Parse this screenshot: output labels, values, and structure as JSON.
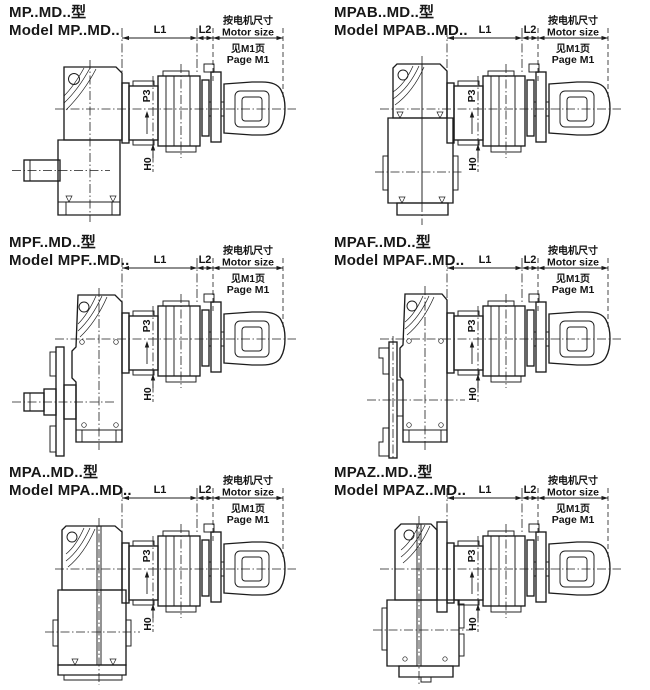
{
  "colors": {
    "background": "#ffffff",
    "line": "#1c1c1c"
  },
  "labels": {
    "l1": "L1",
    "l2": "L2",
    "p3": "P3",
    "h0": "H0",
    "motor_note_cn1": "按电机尺寸",
    "motor_note_en1": "Motor size",
    "motor_note_cn2": "见M1页",
    "motor_note_en2": "Page M1"
  },
  "panels": [
    {
      "id": "mp",
      "title_cn": "MP..MD..型",
      "title_en": "Model MP..MD.."
    },
    {
      "id": "mpab",
      "title_cn": "MPAB..MD..型",
      "title_en": "Model MPAB..MD.."
    },
    {
      "id": "mpf",
      "title_cn": "MPF..MD..型",
      "title_en": "Model MPF..MD.."
    },
    {
      "id": "mpaf",
      "title_cn": "MPAF..MD..型",
      "title_en": "Model MPAF..MD.."
    },
    {
      "id": "mpa",
      "title_cn": "MPA..MD..型",
      "title_en": "Model MPA..MD.."
    },
    {
      "id": "mpaz",
      "title_cn": "MPAZ..MD..型",
      "title_en": "Model MPAZ..MD.."
    }
  ]
}
